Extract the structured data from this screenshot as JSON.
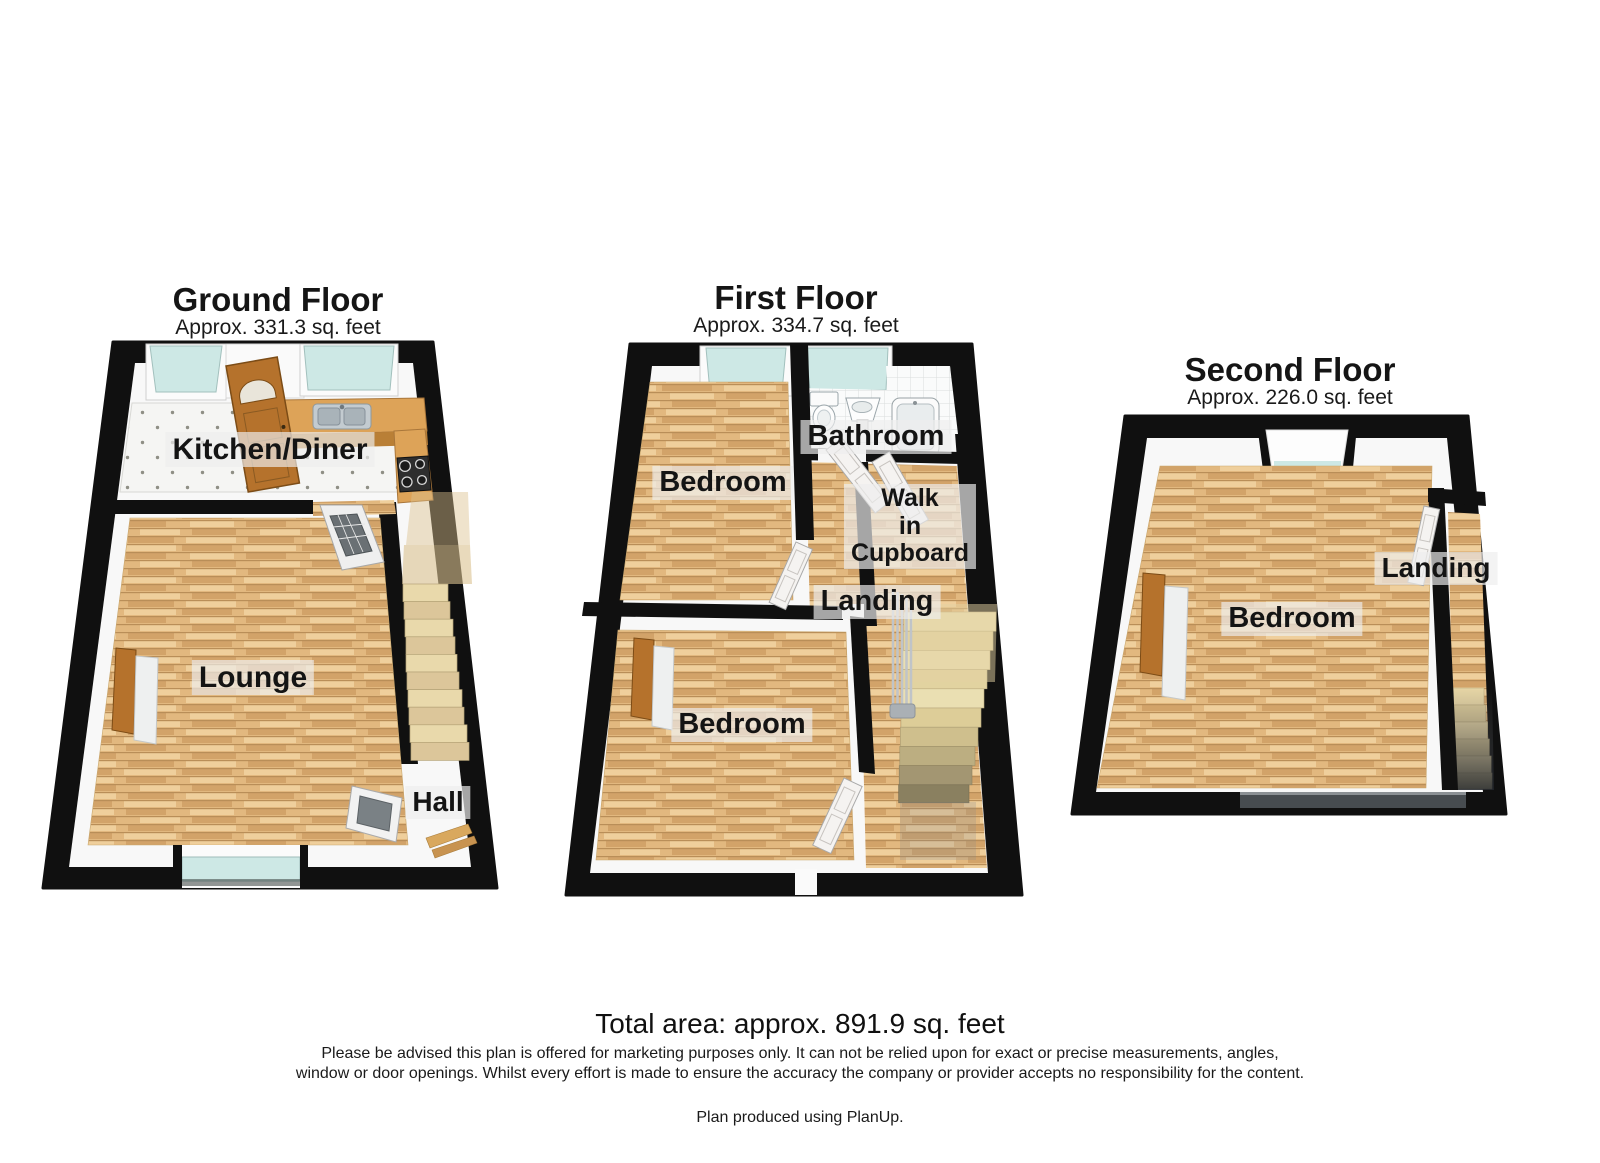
{
  "floors": [
    {
      "title": "Ground Floor",
      "area": "Approx. 331.3 sq. feet",
      "rooms": [
        {
          "label": "Kitchen/Diner"
        },
        {
          "label": "Lounge"
        },
        {
          "label": "Hall"
        }
      ]
    },
    {
      "title": "First Floor",
      "area": "Approx. 334.7 sq. feet",
      "rooms": [
        {
          "label": "Bathroom"
        },
        {
          "label": "Bedroom"
        },
        {
          "label": "Walk in Cupboard",
          "lines": [
            "Walk",
            "in",
            "Cupboard"
          ]
        },
        {
          "label": "Landing"
        },
        {
          "label": "Bedroom"
        }
      ]
    },
    {
      "title": "Second Floor",
      "area": "Approx. 226.0 sq. feet",
      "rooms": [
        {
          "label": "Bedroom"
        },
        {
          "label": "Landing"
        }
      ]
    }
  ],
  "footer": {
    "total_area": "Total area: approx. 891.9 sq. feet",
    "disclaimer": "Please be advised this plan is offered for marketing purposes only. It can not be relied upon for exact or precise measurements, angles, window or door openings. Whilst every effort is made to ensure the accuracy the company or provider accepts no responsibility for the content.",
    "produced_by": "Plan produced using PlanUp."
  },
  "colors": {
    "wall": "#111111",
    "wood_mid": "#e2b87f",
    "wood_dark": "#b98e58",
    "glass": "#cde8e5",
    "counter": "#dda358",
    "stair": "#e9d9ab",
    "door_wood": "#b5722c",
    "label_bg": "rgba(238,238,238,0.68)"
  }
}
